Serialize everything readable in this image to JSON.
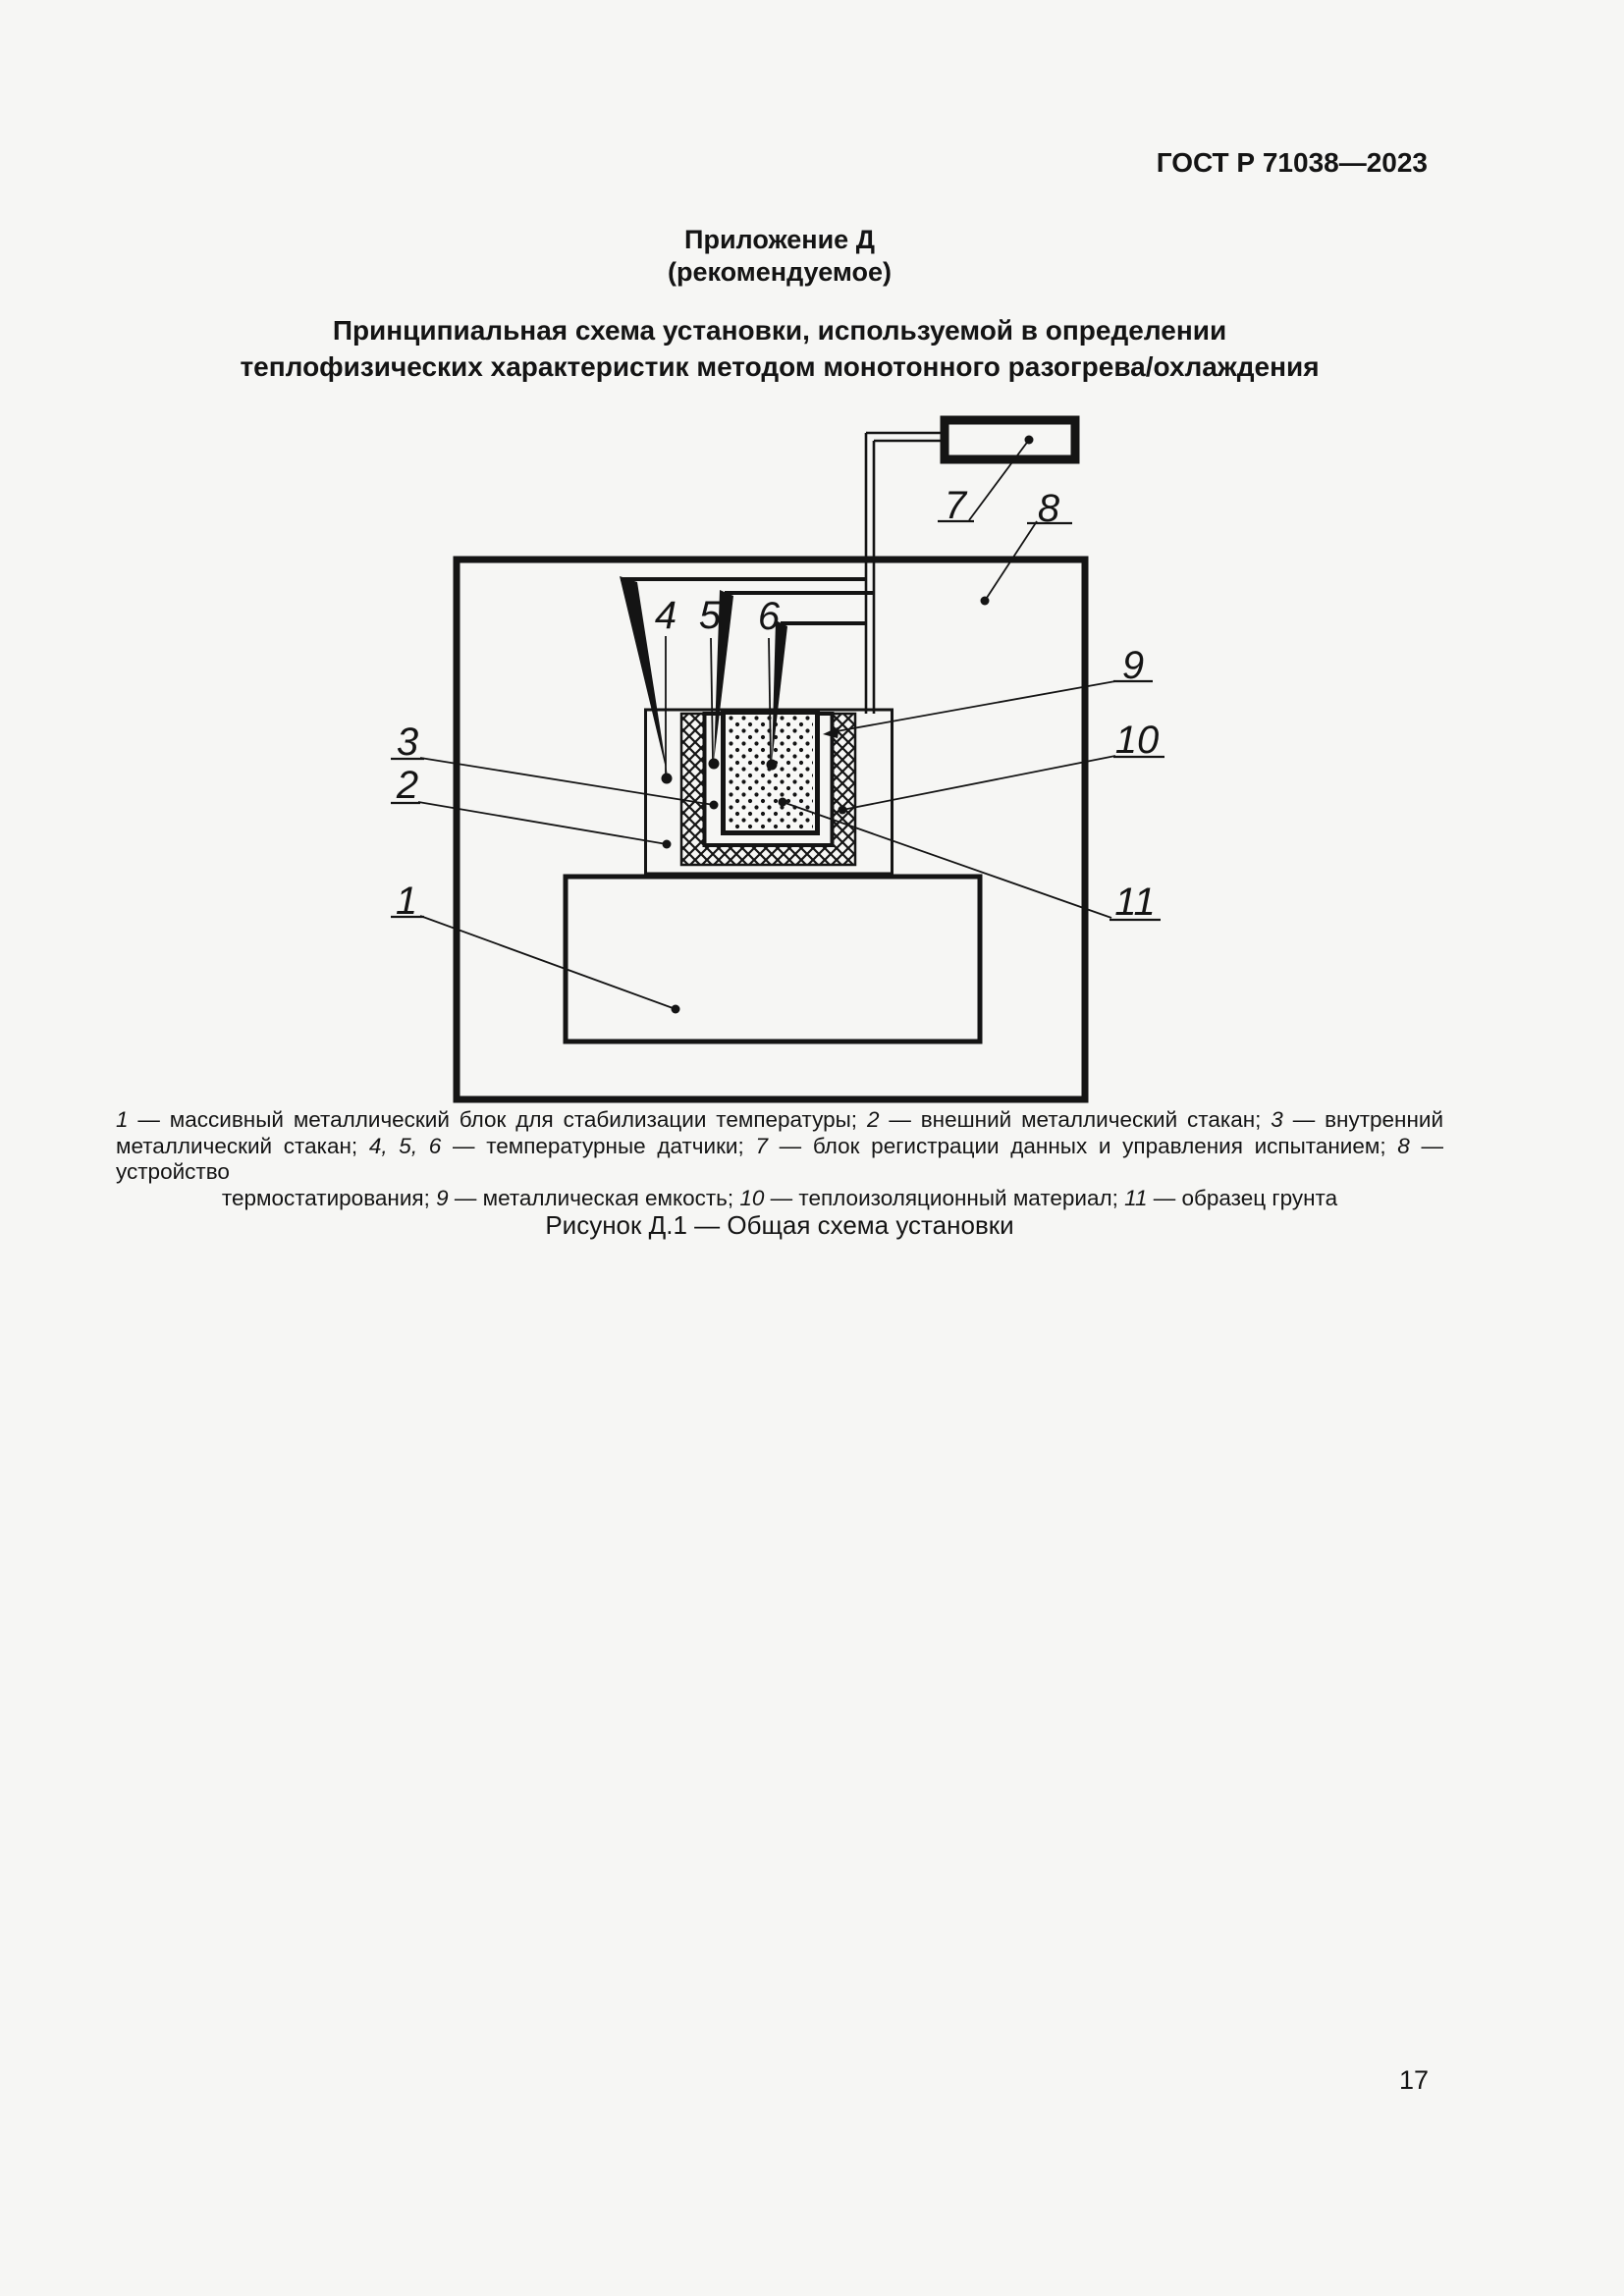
{
  "page": {
    "header": "ГОСТ Р 71038—2023",
    "number": "17"
  },
  "annex": {
    "title": "Приложение Д",
    "subtitle": "(рекомендуемое)"
  },
  "main_title": {
    "line1": "Принципиальная схема установки, используемой в определении",
    "line2": "теплофизических характеристик методом монотонного разогрева/охлаждения"
  },
  "figure": {
    "caption": "Рисунок Д.1 — Общая схема установки",
    "callouts": [
      "1",
      "2",
      "3",
      "4",
      "5",
      "6",
      "7",
      "8",
      "9",
      "10",
      "11"
    ],
    "legend_lines": [
      {
        "align": "justify",
        "segments": [
          {
            "text": "1",
            "italic": true
          },
          {
            "text": " — массивный металлический блок для стабилизации температуры; ",
            "italic": false
          },
          {
            "text": "2",
            "italic": true
          },
          {
            "text": " — внешний металлический стакан; ",
            "italic": false
          },
          {
            "text": "3",
            "italic": true
          },
          {
            "text": " — внутренний",
            "italic": false
          }
        ]
      },
      {
        "align": "justify",
        "segments": [
          {
            "text": "металлический стакан; ",
            "italic": false
          },
          {
            "text": "4, 5, 6",
            "italic": true
          },
          {
            "text": " — температурные датчики; ",
            "italic": false
          },
          {
            "text": "7",
            "italic": true
          },
          {
            "text": " — блок регистрации данных и управления испытанием; ",
            "italic": false
          },
          {
            "text": "8",
            "italic": true
          },
          {
            "text": " — устройство",
            "italic": false
          }
        ]
      },
      {
        "align": "center",
        "segments": [
          {
            "text": "термостатирования; ",
            "italic": false
          },
          {
            "text": "9",
            "italic": true
          },
          {
            "text": " — металлическая емкость; ",
            "italic": false
          },
          {
            "text": "10",
            "italic": true
          },
          {
            "text": " — теплоизоляционный материал; ",
            "italic": false
          },
          {
            "text": "11",
            "italic": true
          },
          {
            "text": " — образец грунта",
            "italic": false
          }
        ]
      }
    ],
    "legend_items": {
      "1": "массивный металлический блок для стабилизации температуры",
      "2": "внешний металлический стакан",
      "3": "внутренний металлический стакан",
      "4_5_6": "температурные датчики",
      "7": "блок регистрации данных и управления испытанием",
      "8": "устройство термостатирования",
      "9": "металлическая емкость",
      "10": "теплоизоляционный материал",
      "11": "образец грунта"
    }
  },
  "colors": {
    "paper": "#f6f6f4",
    "ink": "#141414"
  }
}
